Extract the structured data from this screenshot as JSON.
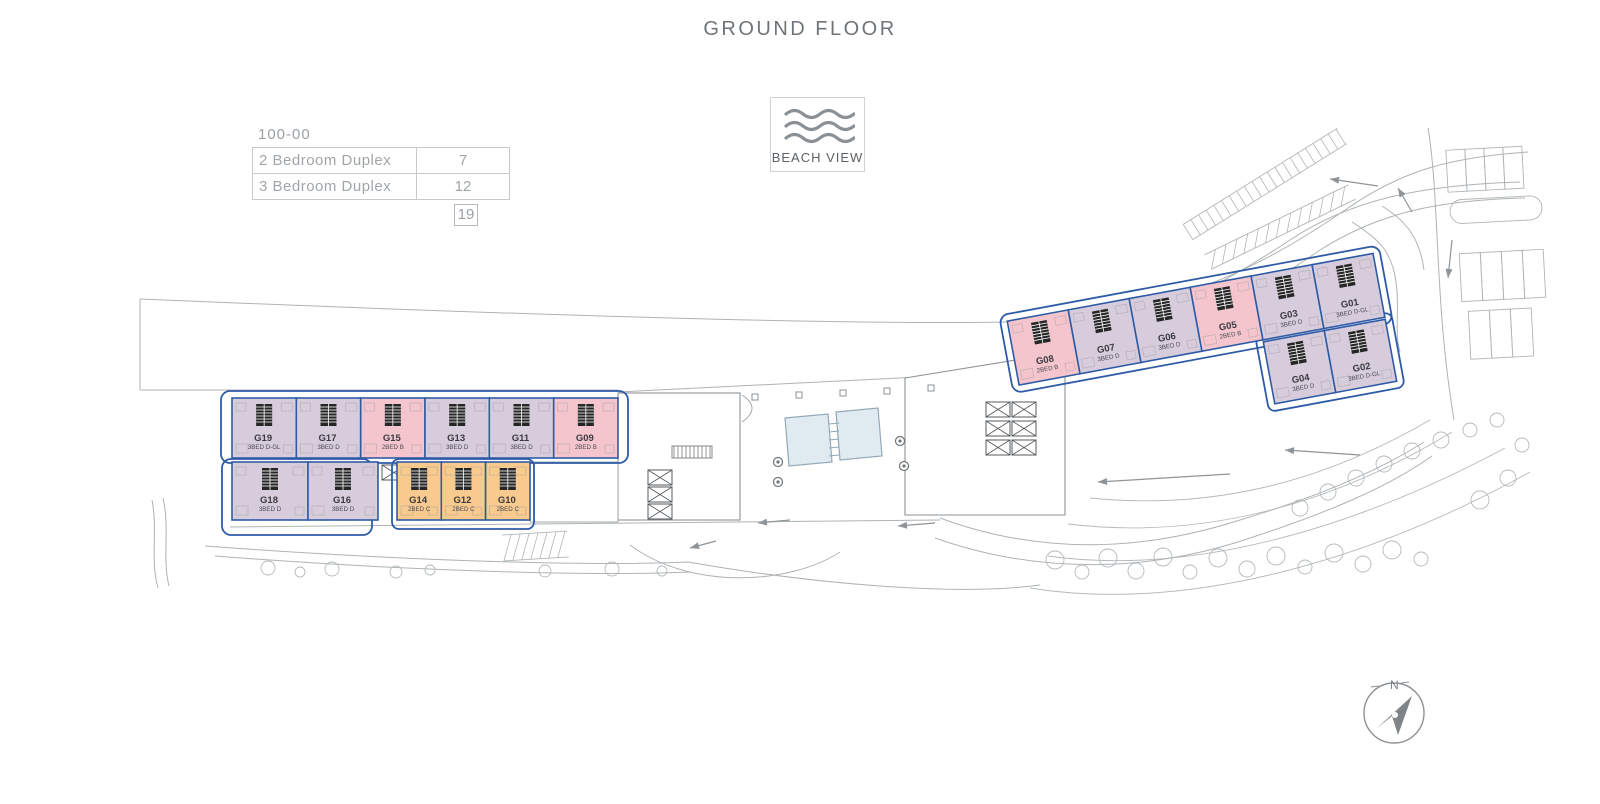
{
  "title": "GROUND FLOOR",
  "legend": {
    "code": "100-00",
    "rows": [
      {
        "label": "2 Bedroom Duplex",
        "count": "7"
      },
      {
        "label": "3 Bedroom Duplex",
        "count": "12"
      }
    ],
    "total": "19"
  },
  "badge": {
    "label": "BEACH VIEW",
    "icon": "waves-icon"
  },
  "compass": {
    "label": "N"
  },
  "colors": {
    "duplex3": "#d7ccdc",
    "duplex2_b": "#f4c5cd",
    "duplex2_c": "#f8ca8e",
    "outline": "#2e5ba6",
    "pool": "#e0ebf1",
    "line": "#a4a9ad",
    "label": "#3a3a40"
  },
  "wings": {
    "left_top_row": [
      {
        "id": "G19",
        "type": "3BED D-GL",
        "cat": "duplex3"
      },
      {
        "id": "G17",
        "type": "3BED D",
        "cat": "duplex3"
      },
      {
        "id": "G15",
        "type": "2BED B",
        "cat": "duplex2_b"
      },
      {
        "id": "G13",
        "type": "3BED D",
        "cat": "duplex3"
      },
      {
        "id": "G11",
        "type": "3BED D",
        "cat": "duplex3"
      },
      {
        "id": "G09",
        "type": "2BED B",
        "cat": "duplex2_b"
      }
    ],
    "left_bottom_row": [
      {
        "id": "G18",
        "type": "3BED D",
        "cat": "duplex3"
      },
      {
        "id": "G16",
        "type": "3BED D",
        "cat": "duplex3"
      },
      {
        "id": "G14",
        "type": "2BED C",
        "cat": "duplex2_c"
      },
      {
        "id": "G12",
        "type": "2BED C",
        "cat": "duplex2_c"
      },
      {
        "id": "G10",
        "type": "2BED C",
        "cat": "duplex2_c"
      }
    ],
    "right_row": [
      {
        "id": "G08",
        "type": "2BED B",
        "cat": "duplex2_b"
      },
      {
        "id": "G07",
        "type": "3BED D",
        "cat": "duplex3"
      },
      {
        "id": "G06",
        "type": "3BED D",
        "cat": "duplex3"
      },
      {
        "id": "G05",
        "type": "2BED B",
        "cat": "duplex2_b"
      },
      {
        "id": "G03",
        "type": "3BED D",
        "cat": "duplex3"
      },
      {
        "id": "G01",
        "type": "3BED D-GL",
        "cat": "duplex3"
      }
    ],
    "right_lower_row": [
      {
        "id": "G04",
        "type": "3BED D",
        "cat": "duplex3"
      },
      {
        "id": "G02",
        "type": "3BED D-GL",
        "cat": "duplex3"
      }
    ]
  }
}
